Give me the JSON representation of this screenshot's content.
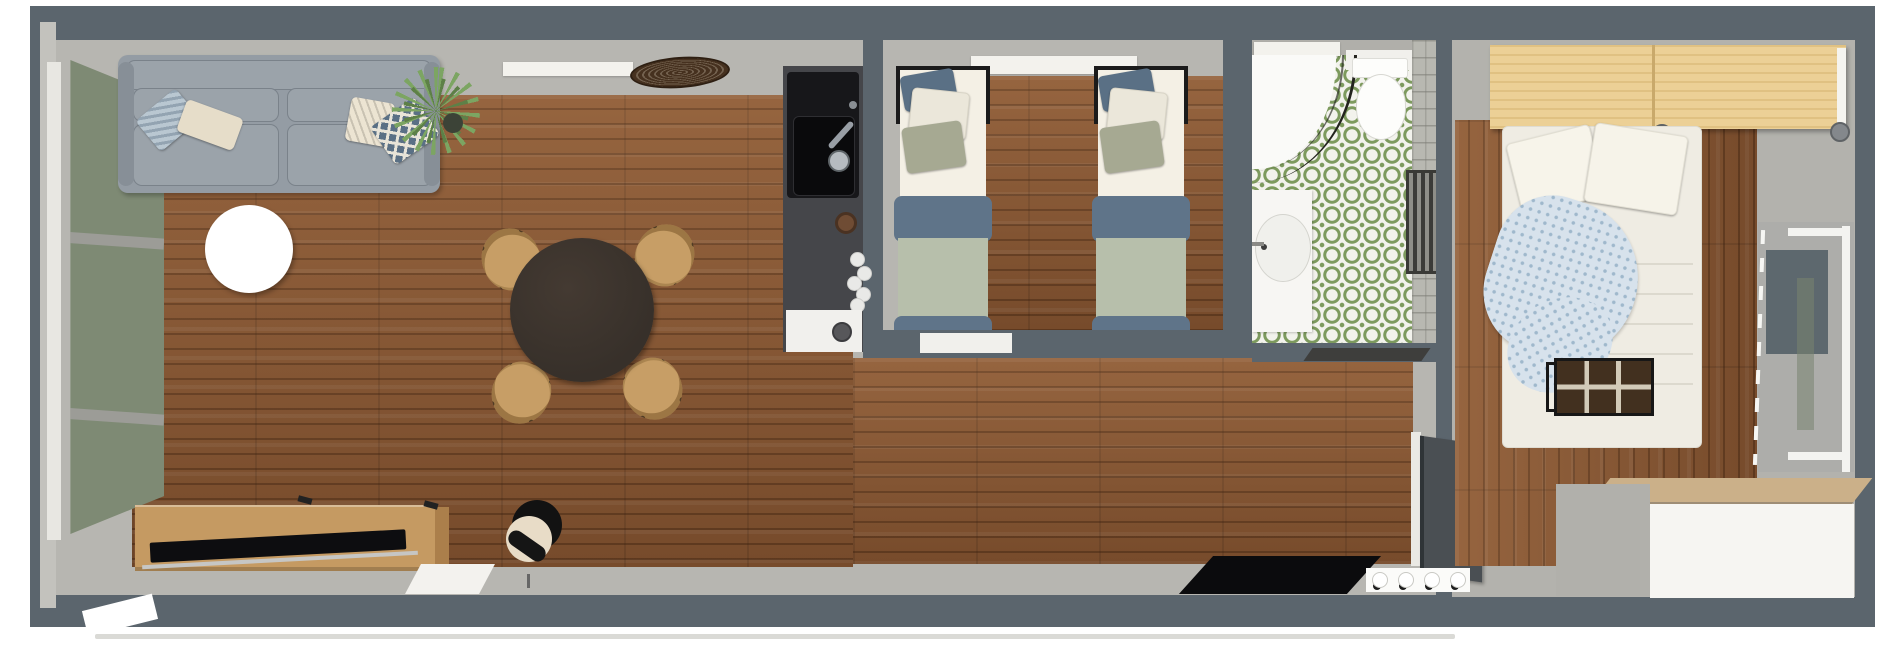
{
  "scene": {
    "view": "3d-top-down-floor-plan-render",
    "description": "Rendered aerial view of a narrow one-storey apartment with living room, kitchenette, twin bedroom, bathroom, hallway and master bedroom"
  },
  "colors": {
    "wall": "#5b656d",
    "interior": "#b7b6b1",
    "interior2": "#b3b2ad",
    "sill": "#f3f2ed",
    "floor": "#8a5732",
    "sofa": "#949ca4",
    "sofa-light": "#9ba3aa",
    "green-door": "#7e8a74",
    "table-dark": "#37302a",
    "chair": "#c79e66",
    "oak": "#c59a62",
    "tv-black": "#0d0d10",
    "counter": "#45464a",
    "sink-black": "#17171a",
    "stove-white": "#f1f0ed",
    "tile-green": "#7d9a5e",
    "sheet": "#f4f0e5",
    "pillow-white": "#ebe7da",
    "pillow-sage": "#a6a992",
    "pillow-navy": "#5a7085",
    "blanket-blue": "#5f7489",
    "duvet-sage": "#b7bfab",
    "wardrobe-pine": "#ecd096",
    "throw": "#d7e2ec",
    "bench": "#42301f",
    "dresser-white": "#f6f5f2",
    "dresser-gray": "#b1b0ab",
    "door-anthracite": "#4a4f53",
    "mat-black": "#0b0b0d",
    "lamp-cream": "#e8dcc7"
  },
  "rooms": [
    {
      "id": "living-room",
      "furniture": [
        "gray-sofa",
        "throw-pillows",
        "round-coffee-table",
        "potted-plant",
        "woven-tray",
        "round-dining-table",
        "rattan-chair x4",
        "tv-sideboard",
        "flat-tv",
        "floor-lamp",
        "glazed-patio-door"
      ]
    },
    {
      "id": "kitchenette",
      "furniture": [
        "charcoal-counter",
        "sink",
        "faucet",
        "coffee-cup",
        "plate-stack",
        "stove-oven"
      ]
    },
    {
      "id": "twin-bedroom",
      "furniture": [
        "single-bed x2",
        "window-sill"
      ]
    },
    {
      "id": "bathroom",
      "furniture": [
        "corner-shower",
        "toilet",
        "vanity-sink",
        "towel-radiator",
        "green-pattern-tile-floor",
        "bath-mat"
      ]
    },
    {
      "id": "hallway",
      "furniture": [
        "entrance-door",
        "black-doormat",
        "wall-hooks"
      ]
    },
    {
      "id": "master-bedroom",
      "furniture": [
        "pine-wardrobe",
        "double-bed",
        "blue-dotted-throw",
        "storage-bench",
        "dresser",
        "clothes-rack",
        "gray-rug"
      ]
    }
  ]
}
